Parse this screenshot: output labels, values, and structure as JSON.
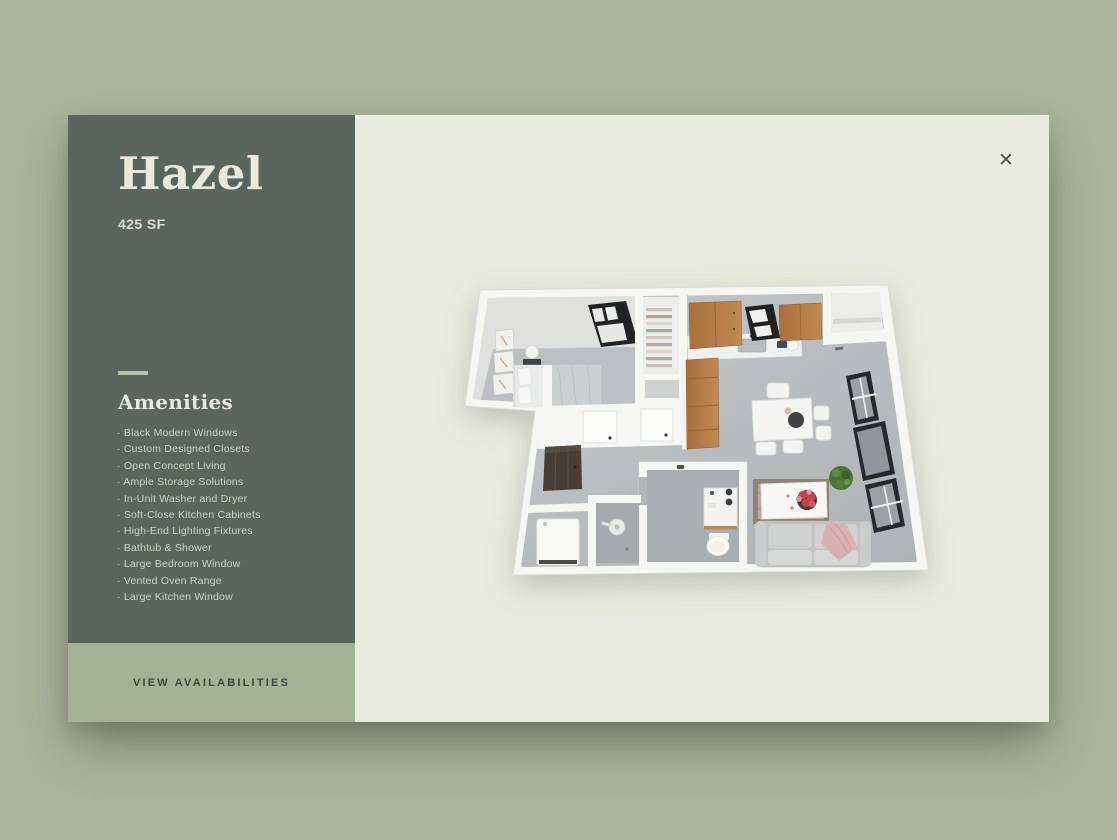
{
  "palette": {
    "page_bg": "#aab49c",
    "sidebar_bg": "#5a655c",
    "panel_bg": "#e9ebde",
    "cta_bg": "#a6b296",
    "title_color": "#ebe9d9",
    "list_color": "#cdd3c5",
    "cta_text": "#3d473c",
    "divider_color": "#b9c2a7",
    "close_color": "#4b5549",
    "kitchen_wood": "#b07840",
    "floor_gray": "#b5babc"
  },
  "sidebar": {
    "title": "Hazel",
    "subtitle": "425 SF",
    "amenities_heading": "Amenities",
    "bullet": "·",
    "amenities": [
      "Black Modern Windows",
      "Custom Designed Closets",
      "Open Concept Living",
      "Ample Storage Solutions",
      "In-Unit Washer and Dryer",
      "Soft-Close Kitchen Cabinets",
      "High-End Lighting Fixtures",
      "Bathtub & Shower",
      "Large Bedroom Window",
      "Vented Oven Range",
      "Large Kitchen Window"
    ],
    "cta_label": "VIEW AVAILABILITIES"
  },
  "main": {
    "close_icon": "✕"
  }
}
